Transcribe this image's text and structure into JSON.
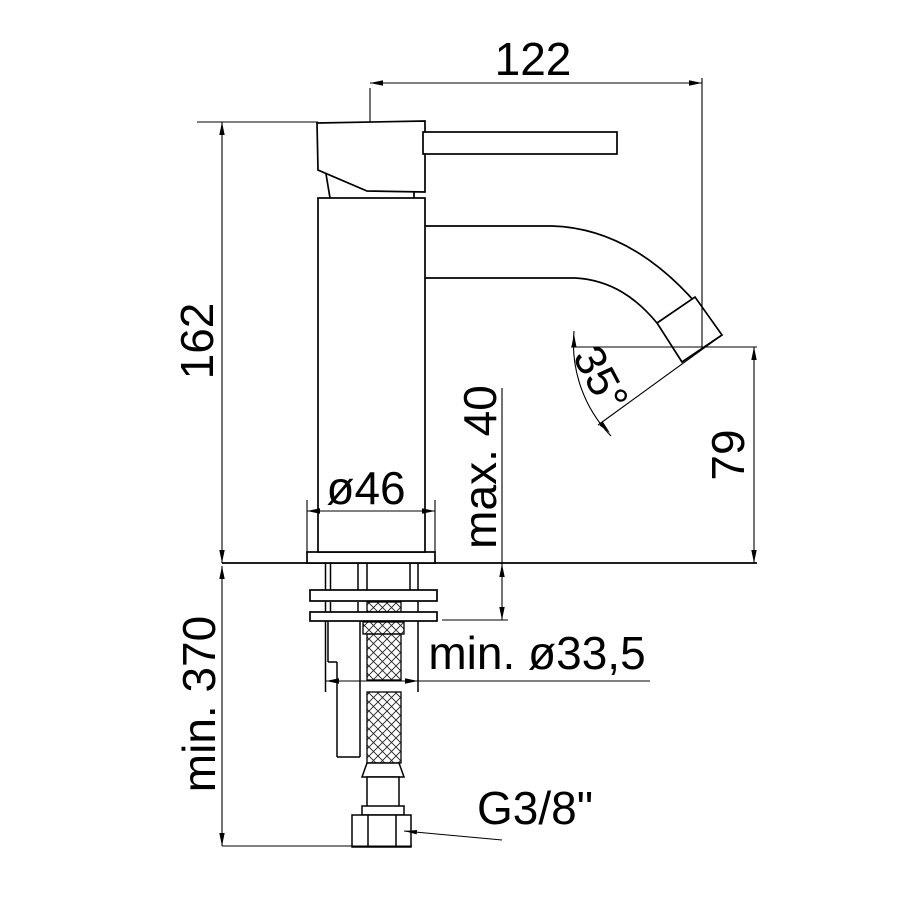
{
  "drawing": {
    "background_color": "#ffffff",
    "line_color": "#000000",
    "labels": {
      "spout_reach": "122",
      "total_height": "162",
      "max_deck_thickness": "max. 40",
      "outlet_height": "79",
      "base_diameter": "ø46",
      "min_hose_length": "min. 370",
      "min_hole_diameter": "min. ø33,5",
      "connection_thread": "G3/8\"",
      "spout_angle": "35°"
    }
  }
}
